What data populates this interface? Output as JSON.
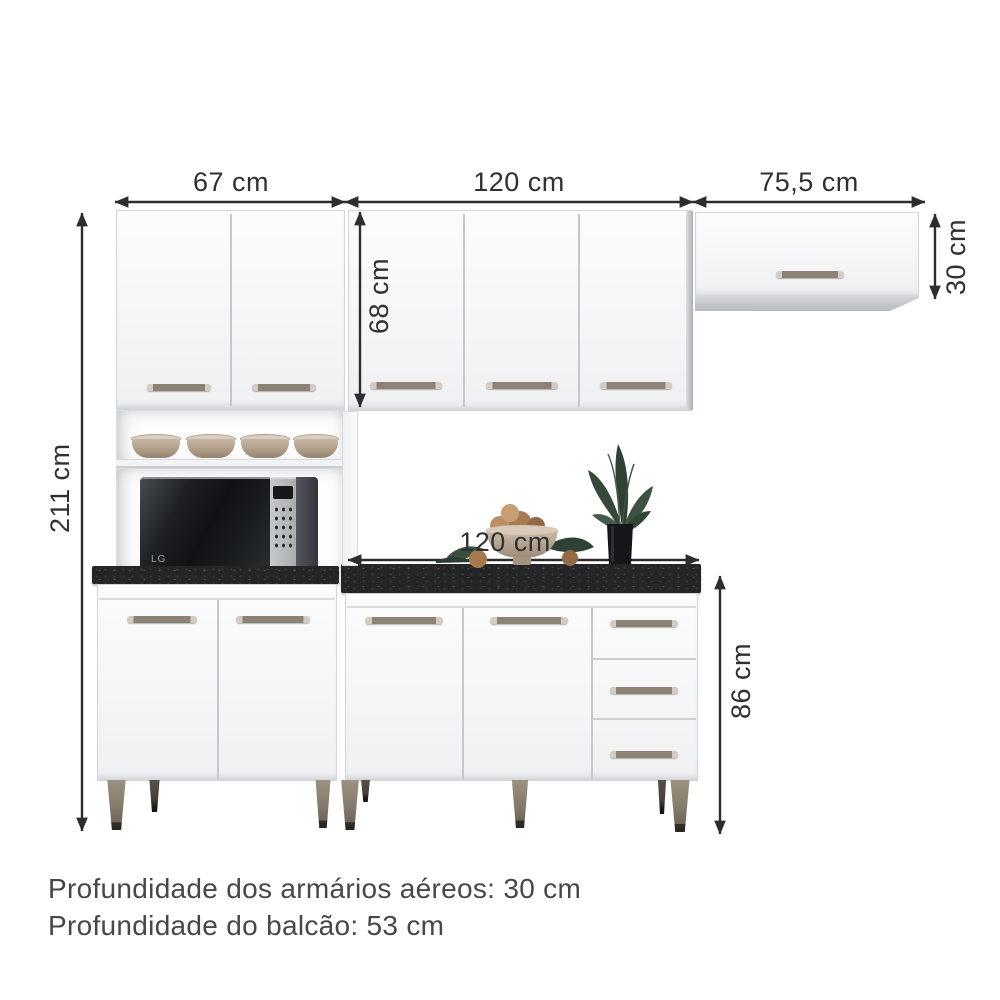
{
  "dimensions": {
    "top_left_width": "67 cm",
    "top_center_width": "120 cm",
    "top_right_width": "75,5 cm",
    "total_height": "211 cm",
    "wall_cabinet_height": "68 cm",
    "right_wall_cabinet_height": "30 cm",
    "counter_width": "120 cm",
    "base_cabinet_height": "86 cm"
  },
  "notes": {
    "wall_cabinet_depth": "Profundidade dos armários aéreos: 30 cm",
    "counter_depth": "Profundidade do balcão: 53 cm"
  },
  "appliance": {
    "brand": "LG"
  },
  "colors": {
    "dimension_ink": "#2d2d2d",
    "cabinet_white": "#f7f8f9",
    "countertop_dark": "#232527",
    "handle_bronze": "#8c8375",
    "leg_wood": "#7b7263",
    "foliage_green": "#3a4d3c"
  }
}
